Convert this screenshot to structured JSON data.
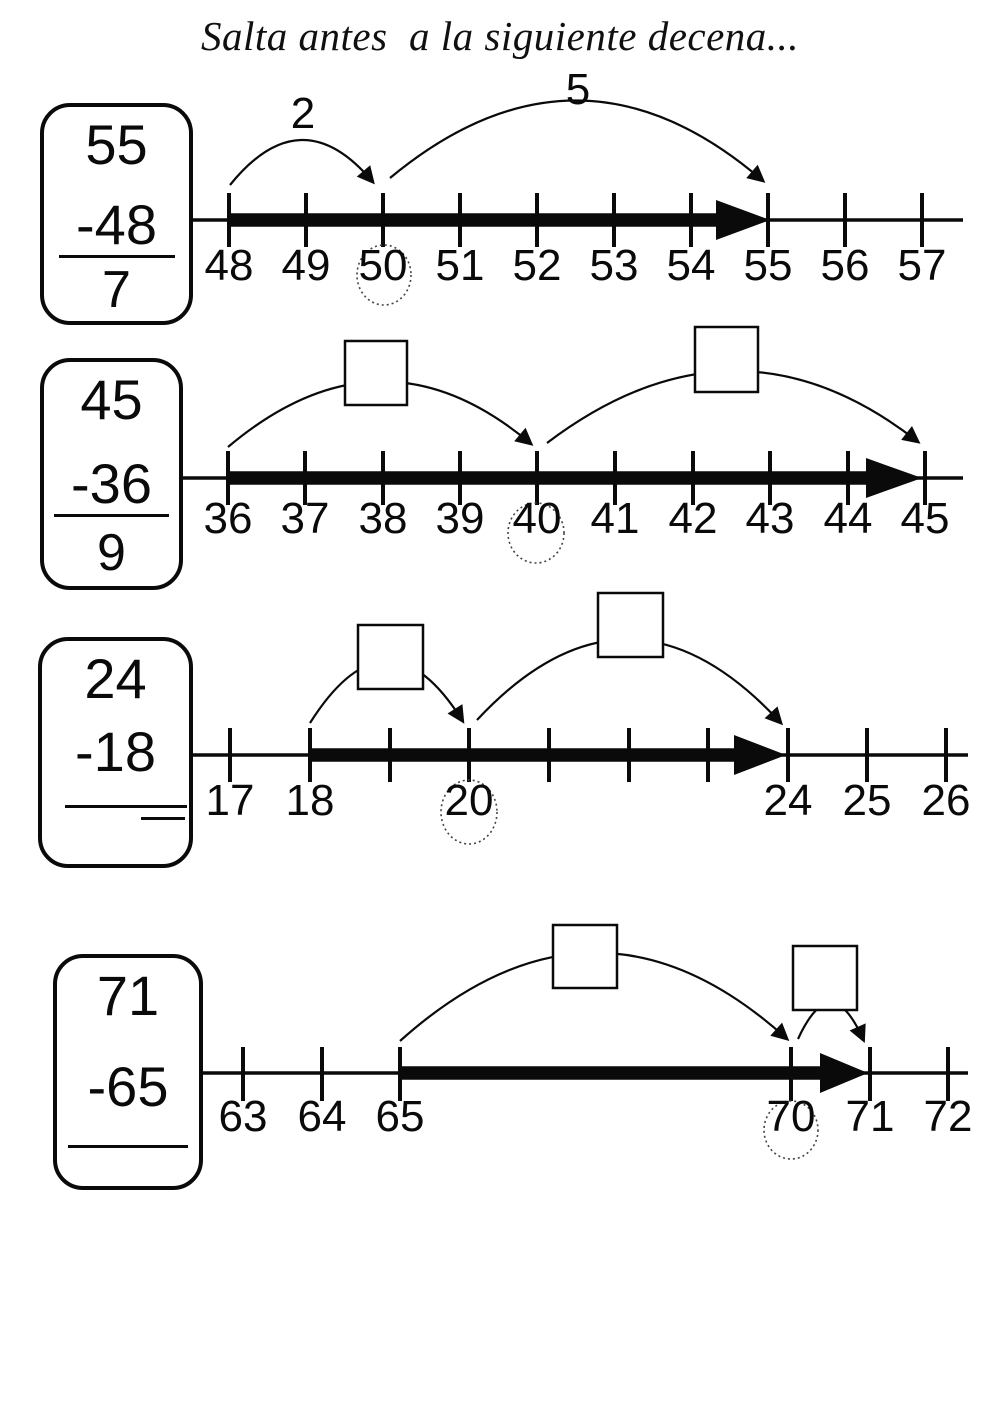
{
  "title": "Salta antes  a la siguiente decena...",
  "colors": {
    "ink": "#0a0a0a",
    "background": "#ffffff"
  },
  "problems": [
    {
      "card": {
        "minuend": "55",
        "subtrahend": "-48",
        "answer": "7"
      },
      "jumps": [
        "2",
        "5"
      ],
      "tick_labels": [
        "48",
        "49",
        "50",
        "51",
        "52",
        "53",
        "54",
        "55",
        "56",
        "57"
      ],
      "circled_tick": "50"
    },
    {
      "card": {
        "minuend": "45",
        "subtrahend": "-36",
        "answer": "9"
      },
      "jumps": [
        "",
        ""
      ],
      "tick_labels": [
        "36",
        "37",
        "38",
        "39",
        "40",
        "41",
        "42",
        "43",
        "44",
        "45"
      ],
      "circled_tick": "40"
    },
    {
      "card": {
        "minuend": "24",
        "subtrahend": "-18",
        "answer": ""
      },
      "jumps": [
        "",
        ""
      ],
      "tick_labels": [
        "17",
        "18",
        "",
        "20",
        "",
        "",
        "",
        "24",
        "25",
        "26"
      ],
      "circled_tick": "20"
    },
    {
      "card": {
        "minuend": "71",
        "subtrahend": "-65",
        "answer": ""
      },
      "jumps": [
        "",
        ""
      ],
      "tick_labels": [
        "63",
        "64",
        "65",
        "70",
        "71",
        "72"
      ],
      "circled_tick": "70"
    }
  ]
}
